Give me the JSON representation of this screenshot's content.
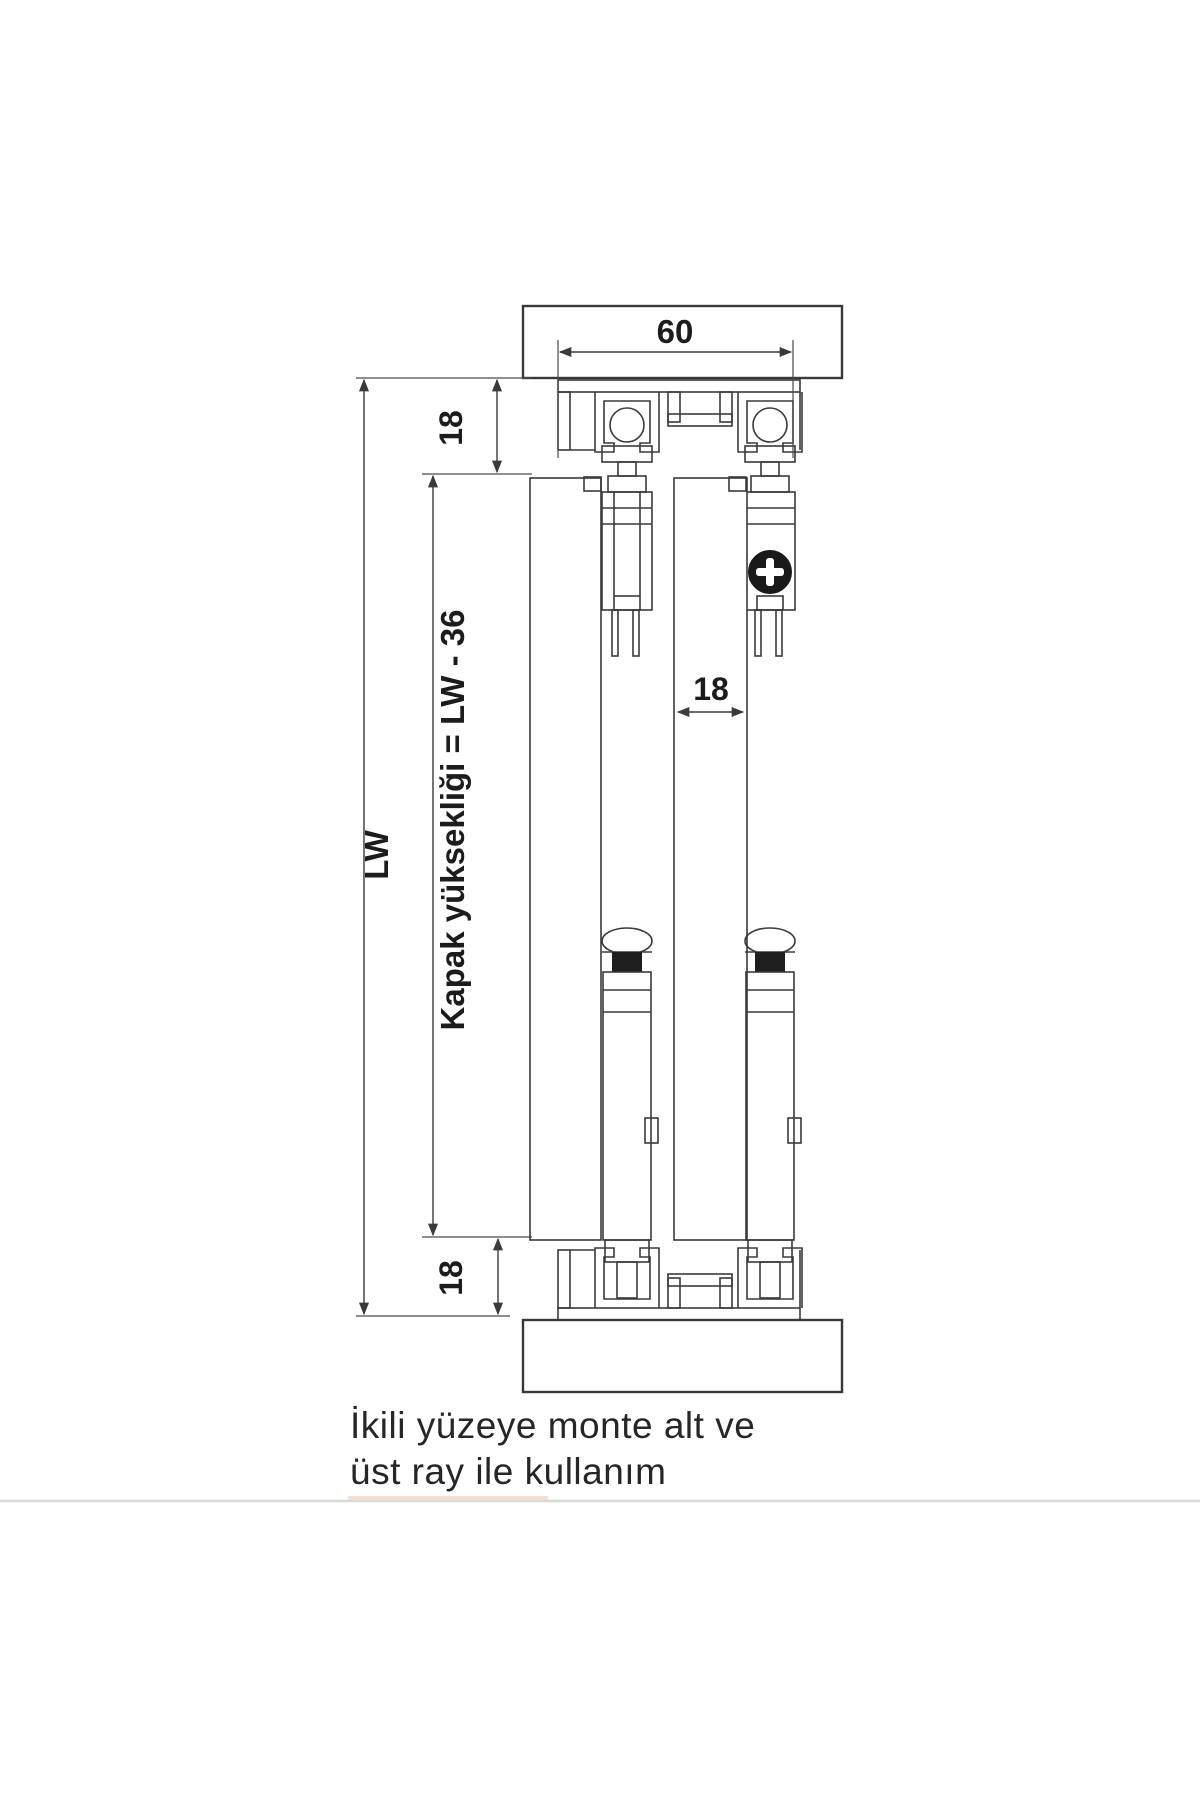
{
  "colors": {
    "background": "#ffffff",
    "line": "#3a3a3a",
    "text": "#1c1c1c",
    "bottom_rule": "#d8d8d8",
    "highlight_segment": "#eec3ab"
  },
  "drawing": {
    "dims": {
      "rail_width": "60",
      "top_clearance": "18",
      "door_thickness": "18",
      "bottom_clearance": "18",
      "opening_height": "LW",
      "door_height_formula": "Kapak yüksekliği  =  LW  - 36"
    },
    "caption": {
      "line1": "İkili yüzeye monte alt ve",
      "line2": "üst ray ile kullanım"
    }
  }
}
